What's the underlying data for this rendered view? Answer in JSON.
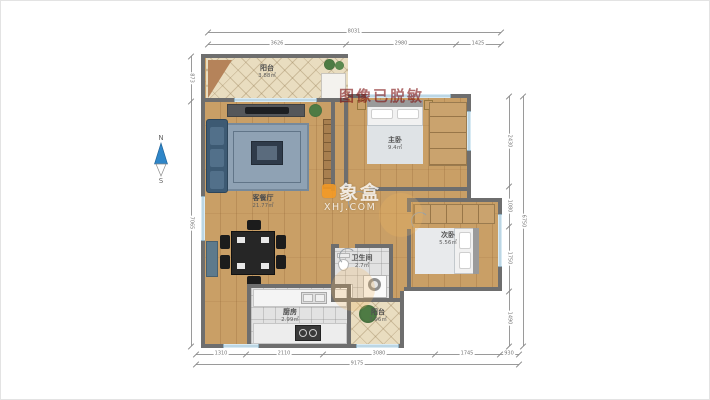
{
  "meta": {
    "privacy_watermark": "图像已脱敏",
    "brand": {
      "logo_icon": "xiangbox-logo",
      "name": "象盒",
      "site": "XHJ.COM"
    },
    "compass": {
      "north": "N",
      "south": "S"
    }
  },
  "rooms": {
    "balcony_top": {
      "name": "阳台",
      "area": "3.88㎡"
    },
    "living_dining": {
      "name": "客餐厅",
      "area": "21.77㎡"
    },
    "master_bedroom": {
      "name": "主卧",
      "area": "9.4㎡"
    },
    "second_bedroom": {
      "name": "次卧",
      "area": "5.56㎡"
    },
    "bathroom": {
      "name": "卫生间",
      "area": "2.7㎡"
    },
    "kitchen": {
      "name": "厨房",
      "area": "2.99㎡"
    },
    "balcony_bottom": {
      "name": "阳台",
      "area": "2.96㎡"
    }
  },
  "dimensions": {
    "top": {
      "total": "8031",
      "segments": [
        "3626",
        "2980",
        "1425"
      ]
    },
    "bottom": {
      "total": "9175",
      "segments": [
        "1310",
        "2110",
        "3080",
        "1745",
        "930"
      ]
    },
    "left": {
      "segments": [
        "873",
        "7065"
      ]
    },
    "right": {
      "total": "6750",
      "segments": [
        "2430",
        "1080",
        "1750",
        "1490"
      ]
    }
  },
  "colors": {
    "accent_orange": "#f59a23",
    "wall": "#6e6e6e",
    "window_blue": "#9fc3d6",
    "wood": "#c99f66"
  }
}
